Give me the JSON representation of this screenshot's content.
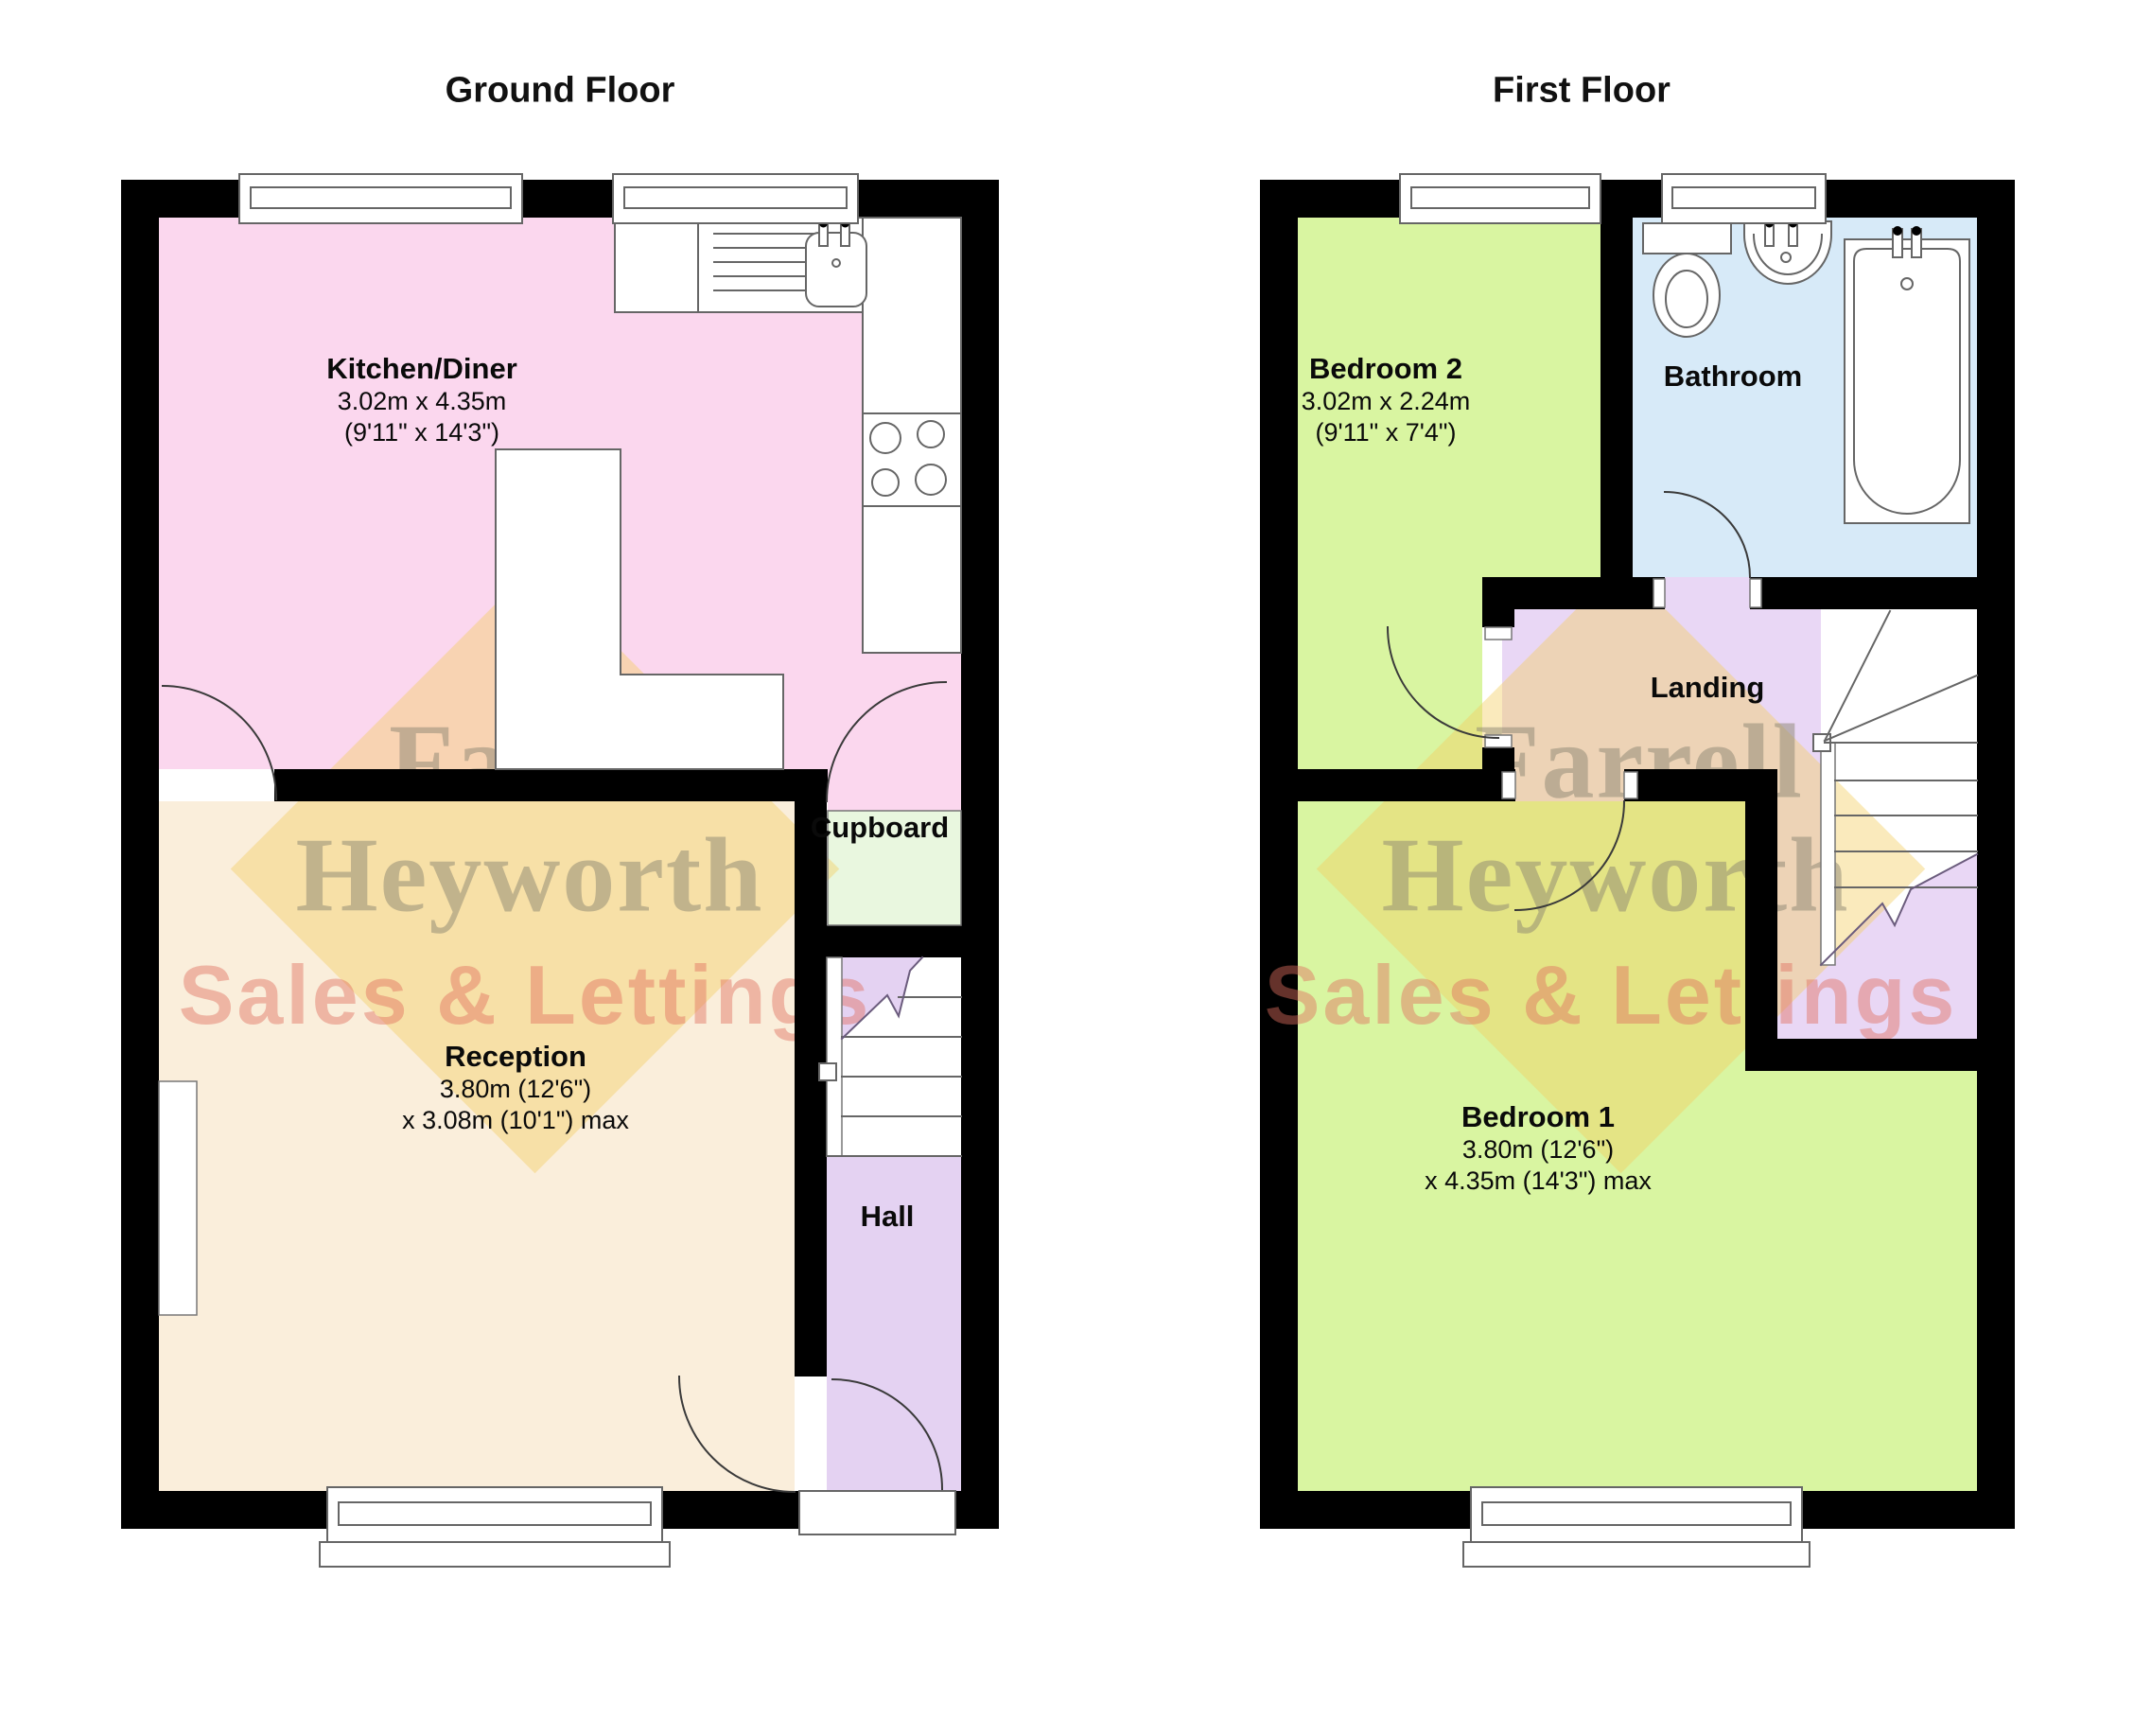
{
  "titles": {
    "ground": "Ground Floor",
    "first": "First Floor"
  },
  "watermark": {
    "line1": "Farrell",
    "line2": "Heyworth",
    "line3": "Sales & Lettings"
  },
  "rooms": {
    "kitchen": {
      "name": "Kitchen/Diner",
      "dim_metric": "3.02m x 4.35m",
      "dim_imperial": "(9'11\" x 14'3\")"
    },
    "reception": {
      "name": "Reception",
      "dim_metric": "3.80m (12'6\")",
      "dim_imperial": "x 3.08m (10'1\") max"
    },
    "cupboard": {
      "name": "Cupboard"
    },
    "hall": {
      "name": "Hall"
    },
    "bedroom2": {
      "name": "Bedroom 2",
      "dim_metric": "3.02m x 2.24m",
      "dim_imperial": "(9'11\" x 7'4\")"
    },
    "bathroom": {
      "name": "Bathroom"
    },
    "landing": {
      "name": "Landing"
    },
    "bedroom1": {
      "name": "Bedroom 1",
      "dim_metric": "3.80m (12'6\")",
      "dim_imperial": "x 4.35m (14'3\") max"
    }
  },
  "colors": {
    "wall": "#000000",
    "kitchen": "#fbd7ee",
    "reception": "#faeedb",
    "cupboard": "#e9f7df",
    "hall": "#e4d2f2",
    "bedroom": "#d9f5a1",
    "bathroom": "#d7eaf8",
    "landing": "#e9d7f5",
    "watermark_diamond": "#f2cd5f",
    "watermark_text": "#8c8773",
    "watermark_sales": "#e16e5f"
  }
}
